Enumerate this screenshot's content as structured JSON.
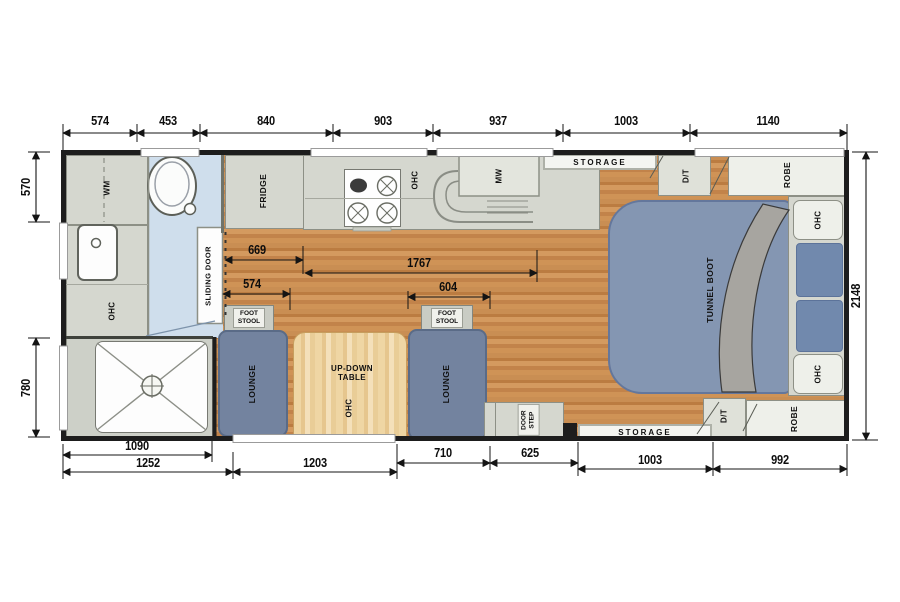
{
  "plan": {
    "dims": {
      "top": [
        "574",
        "453",
        "840",
        "903",
        "937",
        "1003",
        "1140"
      ],
      "bottom": [
        "1090",
        "710",
        "625",
        "1003",
        "992",
        "1252",
        "1203"
      ],
      "left": [
        "570",
        "780"
      ],
      "right": [
        "2148"
      ],
      "interior": [
        "669",
        "1767",
        "574",
        "604"
      ]
    },
    "labels": {
      "wm": "WM",
      "fridge": "FRIDGE",
      "ohc": "OHC",
      "mw": "MW",
      "storage": "STORAGE",
      "dt": "D/T",
      "robe": "ROBE",
      "tunnel_boot": "TUNNEL BOOT",
      "sliding_door": "SLIDING DOOR",
      "foot_stool": "FOOT\nSTOOL",
      "lounge": "LOUNGE",
      "up_down_table": "UP-DOWN\nTABLE",
      "door_step": "DOOR\nSTEP"
    },
    "colors": {
      "wall": "#1d1d1d",
      "cabinet_grey": "#d5d7cf",
      "bathroom_blue": "#cfdeec",
      "wood_floor": "#c5874c",
      "table_timber": "#ecd097",
      "upholstery_blue": "#73839f",
      "bed_blue": "#8496b2",
      "pillow_blue": "#7189ad",
      "blanket_grey": "#a7a5a0"
    }
  }
}
